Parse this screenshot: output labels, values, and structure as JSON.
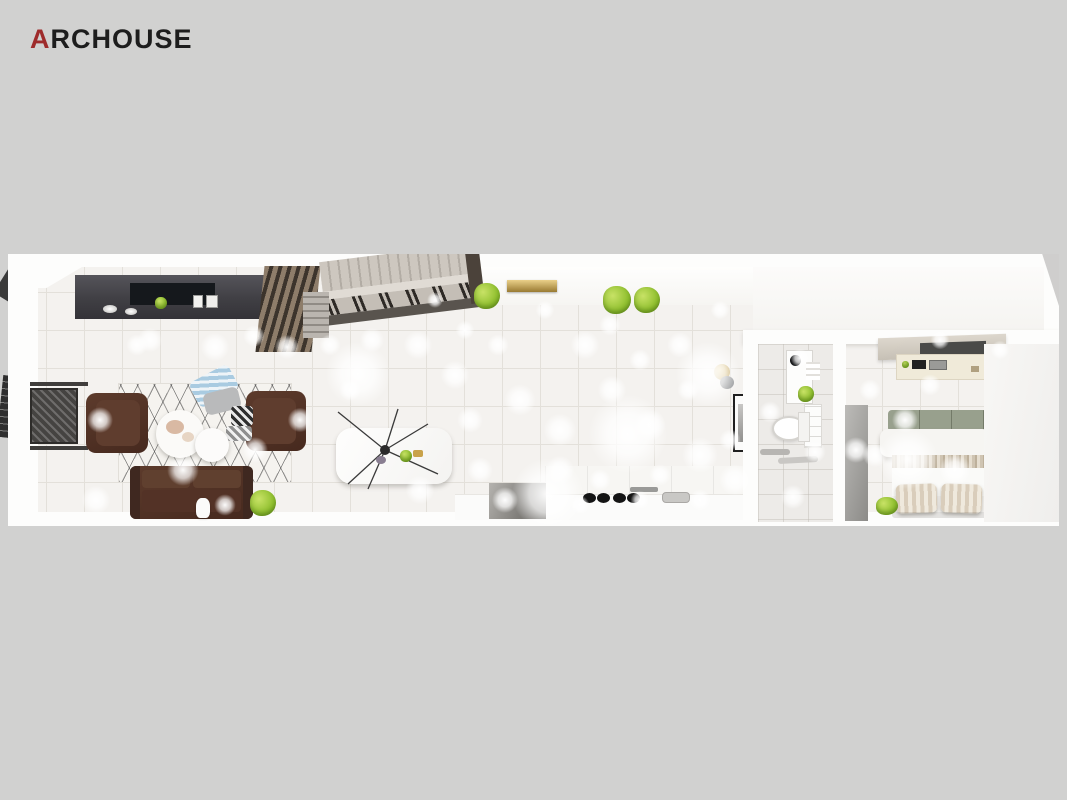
{
  "brand": {
    "logo_prefix": "A",
    "logo_rest": "RCHOUSE",
    "prefix_color": "#9e2b2b",
    "text_color": "#1d1d1d"
  },
  "canvas": {
    "background": "#d1d1d0",
    "render_area": {
      "x": 8,
      "y": 254,
      "width": 1051,
      "height": 272
    }
  },
  "scene": {
    "view": "top-down 3d apartment floor plan render",
    "rooms": [
      {
        "name": "living-room",
        "items": [
          "tv-wall-cabinet",
          "slat-panel",
          "drape-curtains",
          "sheer-curtain",
          "radiator-mesh",
          "armchair-left",
          "armchair-right",
          "geometric-rug",
          "blue-pillow",
          "gray-pillow",
          "checkered-pillows",
          "coffee-table-large",
          "coffee-table-small",
          "leather-sofa",
          "potted-plant",
          "white-vase"
        ]
      },
      {
        "name": "staircase",
        "items": [
          "stair-treads",
          "handrail",
          "railing-slats",
          "landing-steps"
        ]
      },
      {
        "name": "dining-area",
        "items": [
          "dining-table",
          "dining-chairs-x6",
          "spider-chandelier",
          "table-decor"
        ]
      },
      {
        "name": "hallway",
        "items": [
          "wall-planter-x3",
          "gold-wall-shelf",
          "gold-sconce",
          "framed-art"
        ]
      },
      {
        "name": "kitchen",
        "items": [
          "upper-cabinets",
          "countertop",
          "gas-burners",
          "faucet",
          "sink",
          "appliance-panel"
        ]
      },
      {
        "name": "bathroom",
        "items": [
          "mirror-cabinet",
          "towels",
          "toilet",
          "vanity-shelves",
          "vanity-plant",
          "towel-rails",
          "storage-niche-x2"
        ]
      },
      {
        "name": "bedroom",
        "items": [
          "wardrobe-panel",
          "wood-shelf",
          "media-panel",
          "ac-wall-unit",
          "double-bed",
          "headboard-cushions",
          "folded-duvet",
          "striped-blanket",
          "striped-pillows-x2",
          "floor-plant",
          "window-upper",
          "window-lower"
        ]
      }
    ],
    "palette": {
      "floor": "#f4f2ef",
      "tile_line": "#e3e0da",
      "wall": "#fdfdfc",
      "dark_cabinet": "#47464a",
      "leather_brown": "#4f3328",
      "chair_gray": "#b5b2ae",
      "plant_green": "#8fbf2e",
      "gold": "#c9a24a",
      "stair_beige": "#c9c3ba",
      "window_frame": "#2c2c2c",
      "sage_cushion": "#98a08d",
      "bedding_beige": "#cfc3b0"
    },
    "ceiling_lights": [
      [
        142,
        86,
        34
      ],
      [
        207,
        93,
        40
      ],
      [
        246,
        82,
        30
      ],
      [
        279,
        93,
        34
      ],
      [
        129,
        91,
        30
      ],
      [
        92,
        166,
        36
      ],
      [
        175,
        216,
        44
      ],
      [
        88,
        246,
        40
      ],
      [
        217,
        251,
        30
      ],
      [
        247,
        196,
        36
      ],
      [
        322,
        91,
        30
      ],
      [
        364,
        86,
        34
      ],
      [
        410,
        91,
        40
      ],
      [
        342,
        136,
        30
      ],
      [
        292,
        166,
        34
      ],
      [
        447,
        121,
        40
      ],
      [
        462,
        166,
        36
      ],
      [
        490,
        91,
        30
      ],
      [
        512,
        146,
        44
      ],
      [
        537,
        56,
        26
      ],
      [
        552,
        176,
        46
      ],
      [
        577,
        91,
        40
      ],
      [
        602,
        71,
        30
      ],
      [
        604,
        136,
        40
      ],
      [
        632,
        106,
        30
      ],
      [
        642,
        171,
        44
      ],
      [
        672,
        91,
        36
      ],
      [
        680,
        136,
        30
      ],
      [
        692,
        201,
        50
      ],
      [
        712,
        56,
        26
      ],
      [
        727,
        226,
        44
      ],
      [
        552,
        216,
        40
      ],
      [
        472,
        216,
        36
      ],
      [
        412,
        236,
        40
      ],
      [
        497,
        246,
        36
      ],
      [
        427,
        46,
        22
      ],
      [
        457,
        76,
        26
      ],
      [
        862,
        136,
        30
      ],
      [
        897,
        166,
        36
      ],
      [
        922,
        131,
        30
      ],
      [
        947,
        216,
        44
      ],
      [
        867,
        201,
        34
      ],
      [
        932,
        86,
        26
      ],
      [
        992,
        96,
        26
      ],
      [
        848,
        196,
        36
      ],
      [
        792,
        104,
        26
      ],
      [
        762,
        158,
        30
      ],
      [
        807,
        198,
        30
      ],
      [
        785,
        243,
        34
      ],
      [
        592,
        226,
        30
      ],
      [
        652,
        221,
        30
      ],
      [
        572,
        251,
        26
      ],
      [
        632,
        246,
        26
      ],
      [
        692,
        246,
        30
      ],
      [
        722,
        186,
        30
      ],
      [
        350,
        120,
        90
      ],
      [
        620,
        180,
        110
      ],
      [
        540,
        240,
        100
      ],
      [
        700,
        120,
        90
      ],
      [
        900,
        205,
        84
      ]
    ]
  }
}
